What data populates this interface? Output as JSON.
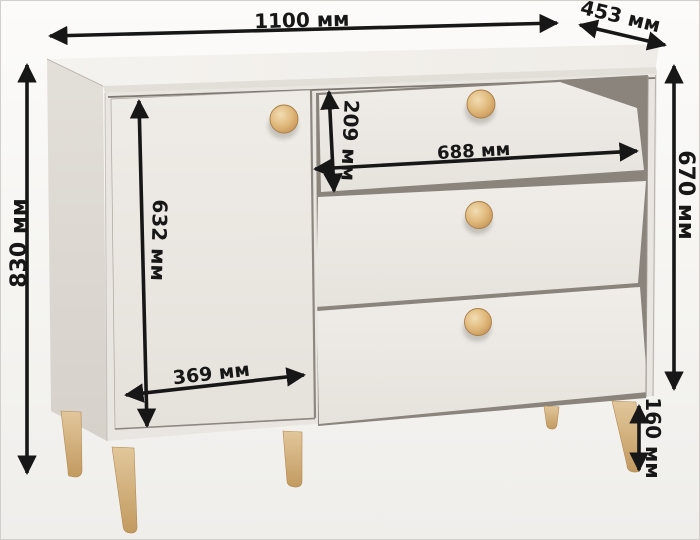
{
  "image": {
    "subject": "chest-of-drawers dimension diagram",
    "unit": "мм"
  },
  "dimensions": {
    "overall_width": {
      "value": 1100,
      "label": "1100 мм"
    },
    "overall_depth": {
      "value": 453,
      "label": "453 мм"
    },
    "overall_height": {
      "value": 830,
      "label": "830 мм"
    },
    "body_height": {
      "value": 670,
      "label": "670 мм"
    },
    "door_height": {
      "value": 632,
      "label": "632 мм"
    },
    "door_width": {
      "value": 369,
      "label": "369 мм"
    },
    "top_drawer_height": {
      "value": 209,
      "label": "209 мм"
    },
    "drawer_width": {
      "value": 688,
      "label": "688 мм"
    },
    "leg_height": {
      "value": 160,
      "label": "160 мм"
    }
  },
  "colors": {
    "background_top": "#fcfbfa",
    "background_bottom": "#efeeeb",
    "frame_border": "#d2cfca",
    "dimension_ink": "#171717",
    "top_face": "#f3f1ed",
    "top_edge": "#e2ded8",
    "left_side": "#dcd8d2",
    "front": "#e9e5e0",
    "door": "#ebe7e2",
    "drawer_face": "#edeae5",
    "interior_shadow": "#8a847d",
    "gap_line": "#7e7872",
    "knob_wood": "#ddb274",
    "leg_wood": "#d2ad79"
  }
}
